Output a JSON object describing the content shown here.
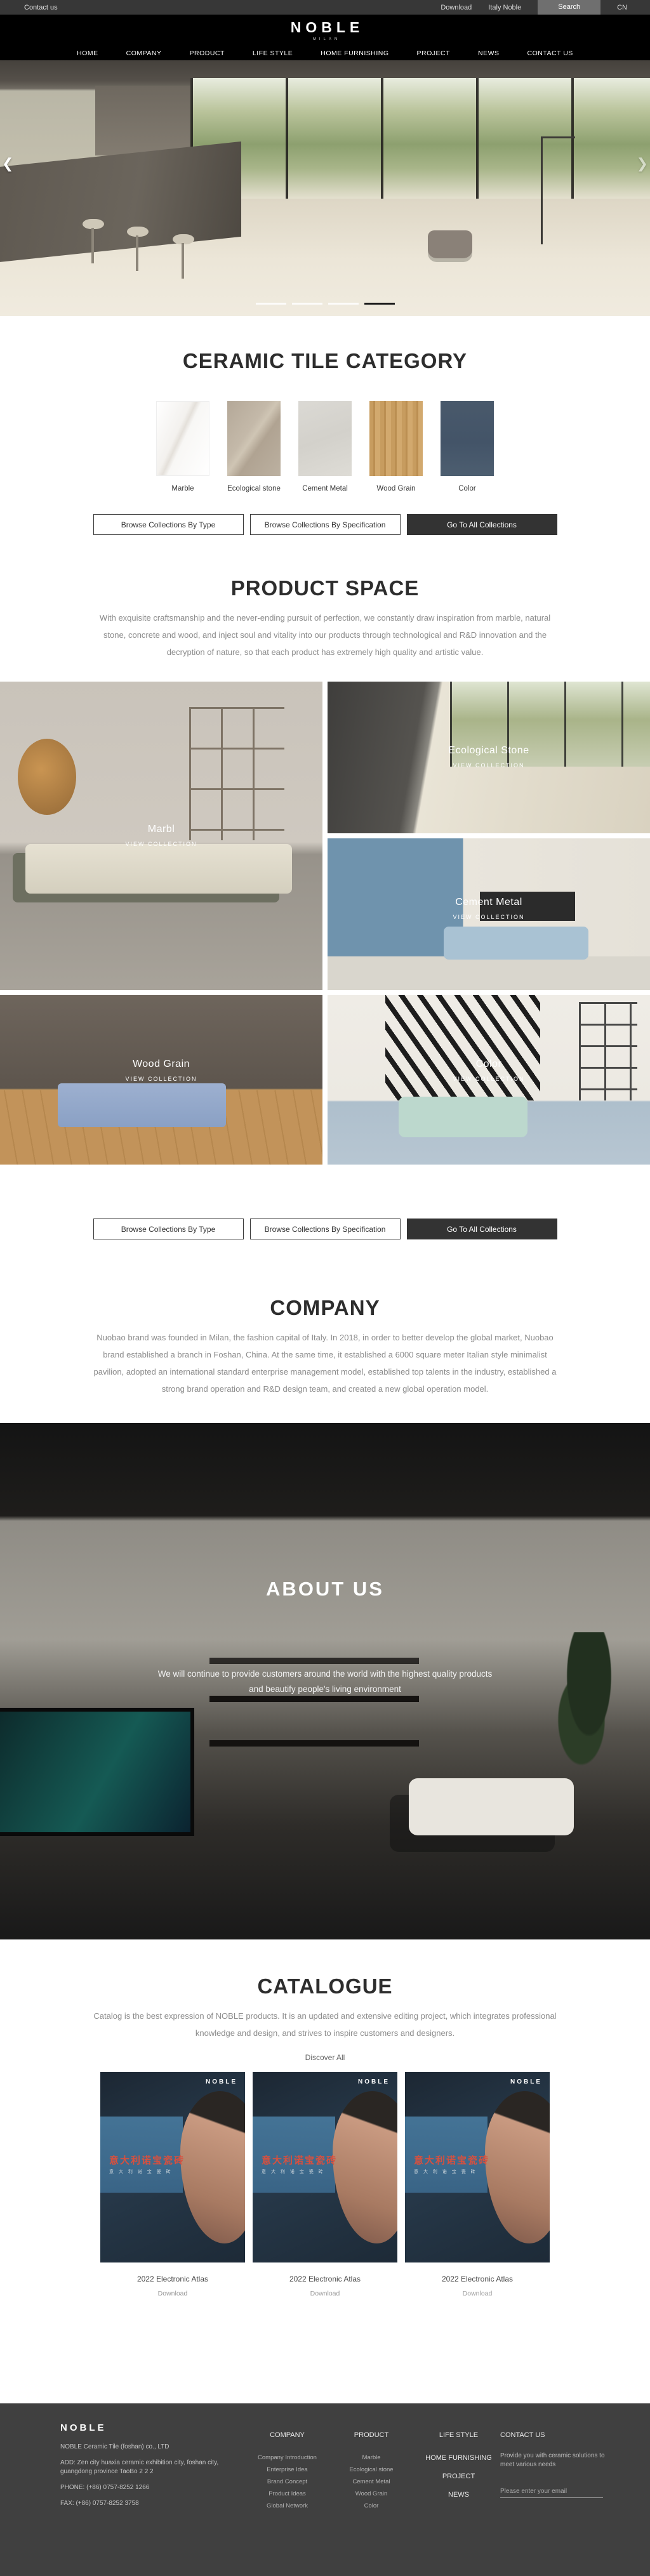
{
  "topbar": {
    "contact": "Contact us",
    "download": "Download",
    "italy": "Italy Noble",
    "search": "Search",
    "lang": "CN",
    "bar_color": "#373737",
    "search_btn_color": "#6f6f6f"
  },
  "brand": {
    "logo": "NOBLE",
    "tagline": "MILAN"
  },
  "nav": {
    "items": [
      "HOME",
      "COMPANY",
      "PRODUCT",
      "LIFE STYLE",
      "HOME FURNISHING",
      "PROJECT",
      "NEWS",
      "CONTACT US"
    ]
  },
  "hero": {
    "prev_arrow": "❮",
    "next_arrow": "❯",
    "slide_count": 4,
    "active_slide": 4
  },
  "category": {
    "title": "CERAMIC TILE CATEGORY",
    "items": [
      {
        "label": "Marble",
        "color": "#f3f1ee"
      },
      {
        "label": "Ecological stone",
        "color": "#bcb1a1"
      },
      {
        "label": "Cement Metal",
        "color": "#d6d4cf"
      },
      {
        "label": "Wood Grain",
        "color": "#c79c5f"
      },
      {
        "label": "Color",
        "color": "#49596b"
      }
    ]
  },
  "buttons": {
    "by_type": "Browse Collections By Type",
    "by_spec": "Browse Collections By Specification",
    "all": "Go To All Collections"
  },
  "product_space": {
    "title": "PRODUCT SPACE",
    "paragraph": "With exquisite craftsmanship and the never-ending pursuit of perfection, we constantly draw inspiration from marble, natural stone, concrete and wood, and inject soul and vitality into our products through technological and R&D innovation and the decryption of nature, so that each product has extremely high quality and artistic value.",
    "view_collection": "VIEW COLLECTION",
    "gallery": [
      {
        "name": "Marbl"
      },
      {
        "name": "Ecological Stone"
      },
      {
        "name": "Cement Metal"
      },
      {
        "name": "Wood Grain"
      },
      {
        "name": "Color"
      }
    ]
  },
  "company": {
    "title": "COMPANY",
    "paragraph": "Nuobao brand was founded in Milan, the fashion capital of Italy. In 2018, in order to better develop the global market, Nuobao brand established a branch in Foshan, China. At the same time, it established a 6000 square meter Italian style minimalist pavilion, adopted an international standard enterprise management model, established top talents in the industry, established a strong brand operation and R&D design team, and created a new global operation model."
  },
  "about": {
    "title": "ABOUT US",
    "line1": "We will continue to provide customers around the world with the highest quality products",
    "line2": "and beautify people's living environment"
  },
  "catalogue": {
    "title": "CATALOGUE",
    "paragraph": "Catalog is the best expression of NOBLE products. It is an updated and extensive editing project, which integrates professional knowledge and design, and strives to inspire customers and designers.",
    "discover": "Discover All",
    "cards": [
      {
        "brand": "NOBLE",
        "title_cn": "意大利诺宝瓷砖",
        "sub": "意 大 利 诺 宝 瓷 砖",
        "caption": "2022 Electronic Atlas",
        "download": "Download"
      },
      {
        "brand": "NOBLE",
        "title_cn": "意大利诺宝瓷砖",
        "sub": "意 大 利 诺 宝 瓷 砖",
        "caption": "2022 Electronic Atlas",
        "download": "Download"
      },
      {
        "brand": "NOBLE",
        "title_cn": "意大利诺宝瓷砖",
        "sub": "意 大 利 诺 宝 瓷 砖",
        "caption": "2022 Electronic Atlas",
        "download": "Download"
      }
    ]
  },
  "footer": {
    "logo": "NOBLE",
    "company_name": "NOBLE Ceramic Tile (foshan) co., LTD",
    "address": "ADD:  Zen city huaxia ceramic exhibition city, foshan city, guangdong province TaoBo 2 2 2",
    "phone": "PHONE:   (+86)  0757-8252 1266",
    "fax": "FAX:   (+86)  0757-8252 3758",
    "columns": [
      {
        "title": "COMPANY",
        "items": [
          "Company Introduction",
          "Enterprise Idea",
          "Brand Concept",
          "Product Ideas",
          "Global Network"
        ]
      },
      {
        "title": "PRODUCT",
        "items": [
          "Marble",
          "Ecological stone",
          "Cement Metal",
          "Wood Grain",
          "Color"
        ]
      }
    ],
    "menu": [
      "LIFE STYLE",
      "HOME FURNISHING",
      "PROJECT",
      "NEWS"
    ],
    "contact": {
      "title": "CONTACT US",
      "text": "Provide you with ceramic solutions to meet various needs",
      "email_placeholder": "Please enter your email"
    },
    "bg_color": "#404040"
  }
}
